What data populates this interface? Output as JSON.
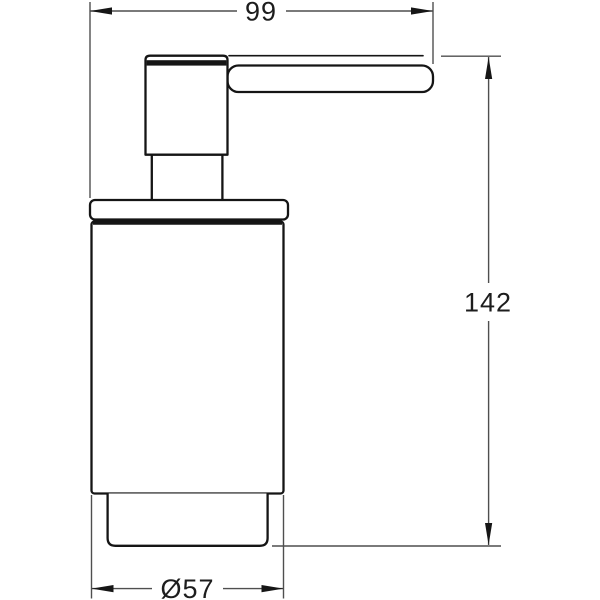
{
  "drawing": {
    "type": "technical-dimension-drawing",
    "subject": "soap-dispenser-side-view"
  },
  "dimensions": {
    "width_label": "99",
    "height_label": "142",
    "diameter_label": "Ø57"
  },
  "colors": {
    "background": "#ffffff",
    "outline": "#151515",
    "dimline": "#4f4f4f",
    "arrowcolor": "#161616",
    "textcolor": "#1d1d1d"
  }
}
